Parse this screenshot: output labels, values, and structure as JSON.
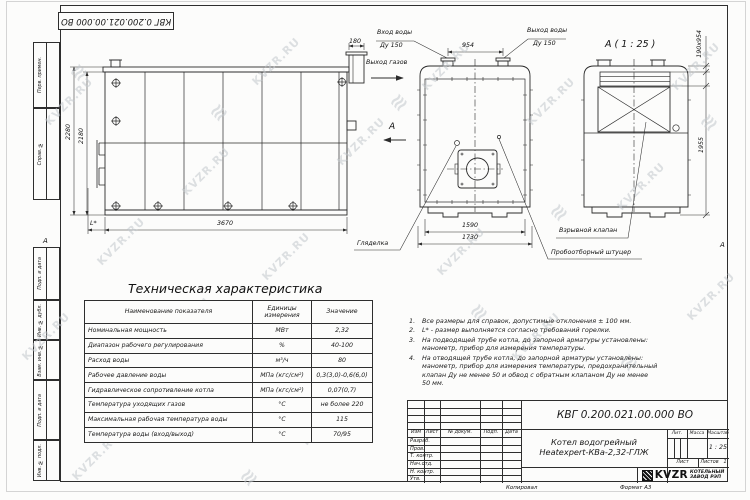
{
  "sheet": {
    "stamp_doc_number": "КВГ 0.200.021.00.000 ВО",
    "zone_marker_left": "А",
    "zone_marker_right": "А",
    "footer": {
      "copied_label": "Копировал",
      "format_label": "Формат А3"
    },
    "margin_labels": {
      "perv_primen": "Перв. примен.",
      "sprav_no": "Справ. №",
      "podp_data_1": "Подп. и дата",
      "inv_dubl": "Инв. № дубл.",
      "vzam_inv": "Взам. инв. №",
      "podp_data_2": "Подп. и дата",
      "inv_podl": "Инв. № подл."
    }
  },
  "watermark": {
    "text": "KVZR.RU",
    "glyph": "≋"
  },
  "views": {
    "side": {
      "dim_2280": "2280",
      "dim_2180": "2180",
      "dim_3670": "3670",
      "dim_l": "L*",
      "dim_180": "180",
      "label_gas_out": "Выход газов"
    },
    "front": {
      "label_water_in_1": "Вход воды",
      "label_water_in_2": "Ду 150",
      "label_water_out_1": "Выход воды",
      "label_water_out_2": "Ду 150",
      "dim_954": "954",
      "dim_1590": "1590",
      "dim_1730": "1730",
      "view_letter": "А",
      "label_sight_glass": "Гляделка",
      "label_sampling": "Пробоотборный штуцер"
    },
    "a_view": {
      "title": "А ( 1 : 25 )",
      "dim_190x954": "190х954",
      "dim_1955": "1955",
      "label_explosion_valve": "Взрывной клапан"
    }
  },
  "spec_table": {
    "title": "Техническая характеристика",
    "headers": [
      "Наименование показателя",
      "Единицы измерения",
      "Значение"
    ],
    "rows": [
      [
        "Номинальная мощность",
        "МВт",
        "2,32"
      ],
      [
        "Диапазон рабочего регулирования",
        "%",
        "40-100"
      ],
      [
        "Расход воды",
        "м³/ч",
        "80"
      ],
      [
        "Рабочее давление воды",
        "МПа (кгс/см²)",
        "0,3(3,0)-0,6(6,0)"
      ],
      [
        "Гидравлическое сопротивление котла",
        "МПа (кгс/см²)",
        "0,07(0,7)"
      ],
      [
        "Температура уходящих газов",
        "°С",
        "не более 220"
      ],
      [
        "Максимальная рабочая температура воды",
        "°С",
        "115"
      ],
      [
        "Температура воды (вход/выход)",
        "°С",
        "70/95"
      ]
    ]
  },
  "notes": {
    "items": [
      {
        "num": "1.",
        "text": "Все размеры для справок, допустимые отклонения ± 100 мм."
      },
      {
        "num": "2.",
        "text": "L* - размер выполняется согласно требований горелки."
      },
      {
        "num": "3.",
        "text": "На подводящей трубе котла, до запорной арматуры установлены:\nманометр, прибор для измерения температуры."
      },
      {
        "num": "4.",
        "text": "На отводящей трубе котла, до запорной арматуры установлены:\nманометр, прибор для измерения температуры, предохранительный\nклапан Ду не менее 50 и обвод с обратным клапаном Ду не менее\n50 мм."
      }
    ]
  },
  "title_block": {
    "doc_number": "КВГ 0.200.021.00.000 ВО",
    "name_line1": "Котел водогрейный",
    "name_line2": "Heatexpert-КВа-2,32-ГЛЖ",
    "col_izm": "Изм",
    "col_list": "Лист",
    "col_doc": "№ докум.",
    "col_podp": "Подп.",
    "col_data": "Дата",
    "row_razrab": "Разраб.",
    "row_prov": "Пров.",
    "row_tkontr": "Т. контр.",
    "row_nachotd": "Нач.отд.",
    "row_nkontr": "Н. контр.",
    "row_utv": "Утв.",
    "lit_label": "Лит.",
    "mass_label": "Масса",
    "scale_label": "Масштаб",
    "scale_value": "1 : 25",
    "sheet_label": "Лист",
    "sheets_label": "Листов",
    "sheets_value": "1",
    "logo_text": "KVZR",
    "org_line1": "КОТЕЛЬНЫЙ",
    "org_line2": "ЗАВОД РЭП"
  }
}
